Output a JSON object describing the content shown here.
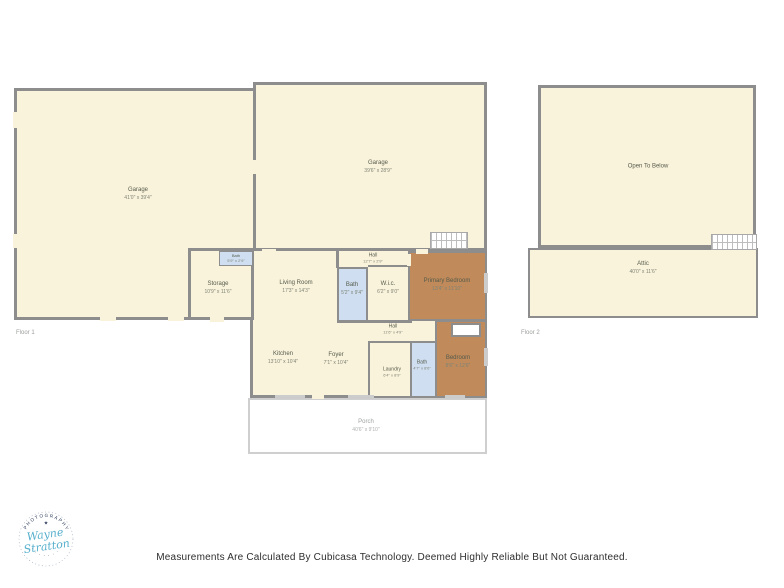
{
  "colors": {
    "room_fill": "#FAF3DB",
    "bath_fill": "#CFDFF1",
    "bedroom_fill": "#C08A5A",
    "wall": "#8D8D8D",
    "label": "#555B4C",
    "dims": "#7F8476",
    "logo_blue": "#57B0CD",
    "logo_navy": "#31405C"
  },
  "floor1": {
    "label": "Floor 1",
    "rooms": {
      "garage_left": {
        "name": "Garage",
        "dims": "41'0\" x 39'4\""
      },
      "garage_top": {
        "name": "Garage",
        "dims": "39'6\" x 28'9\""
      },
      "storage": {
        "name": "Storage",
        "dims": "10'9\" x 11'6\""
      },
      "bath1": {
        "name": "Bath",
        "dims": "5'9\" x 2'9\""
      },
      "living_room": {
        "name": "Living Room",
        "dims": "17'3\" x 14'3\""
      },
      "bath2": {
        "name": "Bath",
        "dims": "5'2\" x 9'4\""
      },
      "wic": {
        "name": "W.i.c.",
        "dims": "6'2\" x 9'0\""
      },
      "hall_top": {
        "name": "Hall",
        "dims": "12'7\" x 2'9\""
      },
      "primary_bedroom": {
        "name": "Primary Bedroom",
        "dims": "13'4\" x 11'10\""
      },
      "hall_bottom": {
        "name": "Hall",
        "dims": "11'6\" x 4'9\""
      },
      "kitchen": {
        "name": "Kitchen",
        "dims": "13'10\" x 10'4\""
      },
      "foyer": {
        "name": "Foyer",
        "dims": "7'1\" x 10'4\""
      },
      "laundry": {
        "name": "Laundry",
        "dims": "6'4\" x 8'9\""
      },
      "bath3": {
        "name": "Bath",
        "dims": "4'7\" x 8'6\""
      },
      "bedroom": {
        "name": "Bedroom",
        "dims": "8'6\" x 12'6\""
      },
      "porch": {
        "name": "Porch",
        "dims": "40'6\" x 9'10\""
      }
    }
  },
  "floor2": {
    "label": "Floor 2",
    "rooms": {
      "open_to_below": {
        "name": "Open To Below",
        "dims": ""
      },
      "attic": {
        "name": "Attic",
        "dims": "40'0\" x 11'6\""
      }
    }
  },
  "logo": {
    "arc_top": "PHOTOGRAPHY",
    "arc_bottom": "· · · · · · · · ·",
    "star": "★",
    "name_line1": "Wayne",
    "name_line2": "Stratton"
  },
  "footer": {
    "disclaimer": "Measurements Are Calculated By Cubicasa Technology. Deemed Highly Reliable But Not Guaranteed."
  }
}
